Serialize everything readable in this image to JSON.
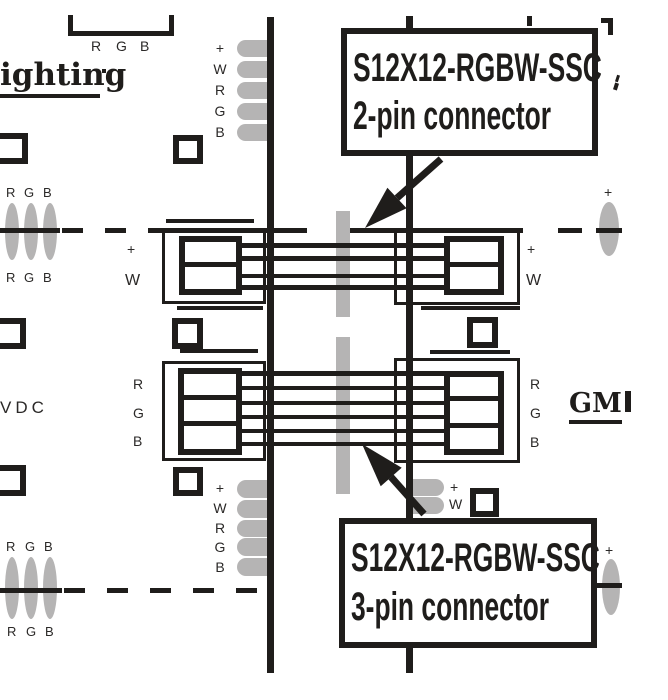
{
  "colors": {
    "ink": "#1f1d1b",
    "pad_gray": "#b5b4b4"
  },
  "callout_2pin": {
    "line1": "S12X12-RGBW-SSC",
    "line2": "2-pin connector"
  },
  "callout_3pin": {
    "line1": "S12X12-RGBW-SSC",
    "line2": "3-pin connector"
  },
  "branding": {
    "left_logo_partial": "ighting",
    "right_logo_partial": "GM"
  },
  "voltage_label": "VDC",
  "bracket_labels": [
    "R",
    "G",
    "B"
  ],
  "pad_groups": {
    "left_top": [
      "+",
      "W",
      "R",
      "G",
      "B"
    ],
    "left_bottom": [
      "+",
      "W",
      "R",
      "G",
      "B"
    ],
    "right_bottom": [
      "+",
      "W"
    ]
  },
  "cutline_labels": {
    "left_top_above": [
      "R",
      "G",
      "B"
    ],
    "left_top_below": [
      "R",
      "G",
      "B"
    ],
    "left_bottom_above": [
      "R",
      "G",
      "B"
    ],
    "left_bottom_below": [
      "R",
      "G",
      "B"
    ],
    "right_top": "+",
    "right_bottom": "+"
  },
  "connector_labels": {
    "left_2pin": [
      "+",
      "W"
    ],
    "right_2pin": [
      "+",
      "W"
    ],
    "left_3pin": [
      "R",
      "G",
      "B"
    ],
    "right_3pin": [
      "R",
      "G",
      "B"
    ]
  }
}
